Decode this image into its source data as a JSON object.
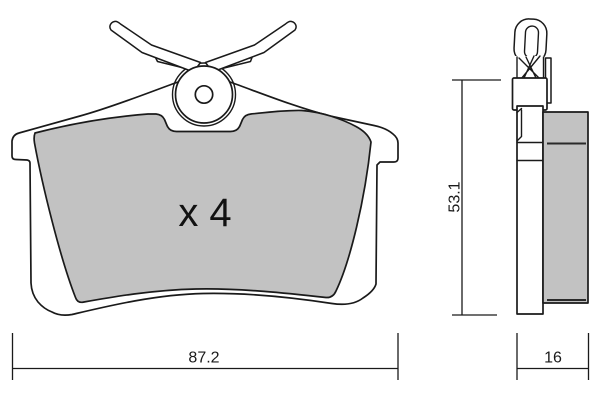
{
  "front_view": {
    "quantity_label": "x 4"
  },
  "dimensions": {
    "width_mm": "87.2",
    "height_mm": "53.1",
    "thickness_mm": "16"
  },
  "colors": {
    "line": "#1a1a1a",
    "friction": "#c2c2c2",
    "background": "#ffffff"
  }
}
